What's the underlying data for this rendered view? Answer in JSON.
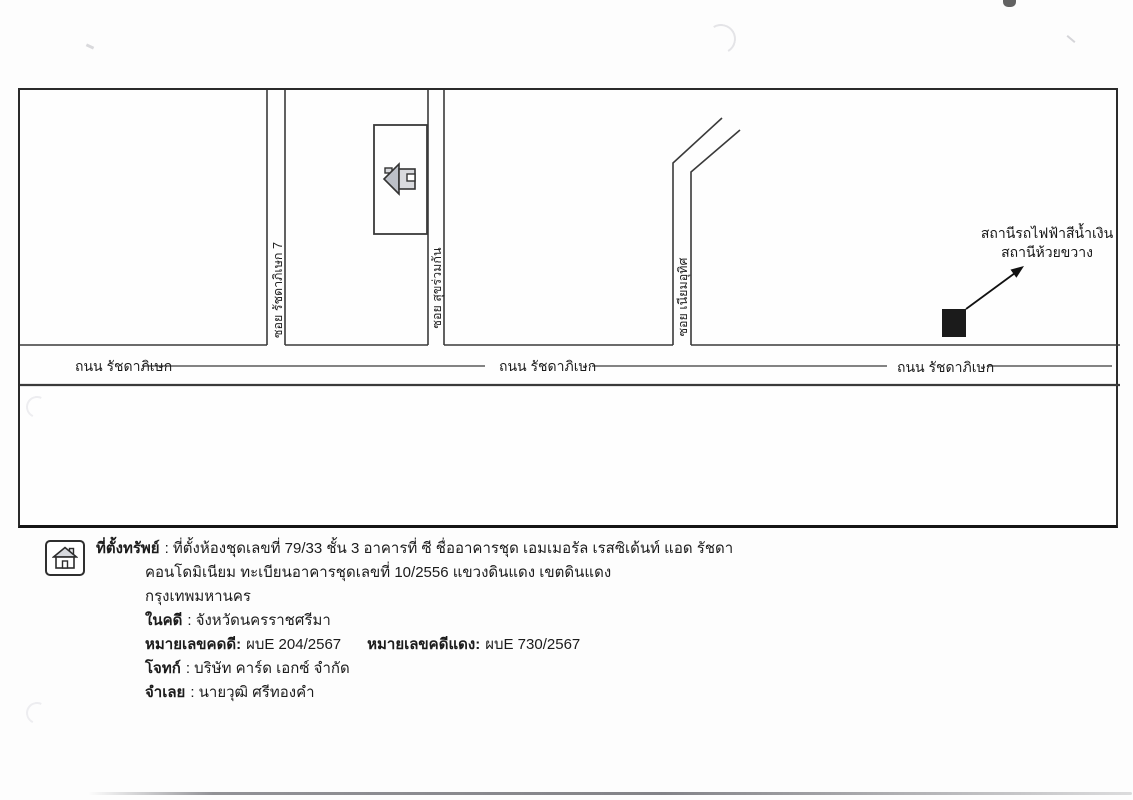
{
  "map": {
    "road_label_left": "ถนน รัชดาภิเษก",
    "road_label_center": "ถนน รัชดาภิเษก",
    "road_label_right": "ถนน รัชดาภิเษก",
    "soi_label_1": "ซอย รัชดาภิเษก 7",
    "soi_label_2": "ซอย สุขร่วมกัน",
    "soi_label_3": "ซอย เนียมอุทิศ",
    "station_note_line1": "สถานีรถไฟฟ้าสีน้ำเงิน",
    "station_note_line2": "สถานีห้วยขวาง",
    "markers": {
      "property": "house-icon",
      "station": "black-square-marker",
      "pointer": "arrow-icon"
    },
    "colors": {
      "line": "#3a3a3a",
      "station_marker_fill": "#1b1b1b",
      "house_roof": "#bcc0c8",
      "house_body": "#d9dade"
    }
  },
  "info": {
    "legend_icon": "house-icon",
    "location": {
      "label": "ที่ตั้งทรัพย์",
      "line1": ": ที่ตั้งห้องชุดเลขที่ 79/33 ชั้น 3 อาคารที่ ซี ชื่ออาคารชุด เอมเมอรัล เรสซิเด้นท์ แอด รัชดา",
      "line2": "คอนโดมิเนียม ทะเบียนอาคารชุดเลขที่ 10/2556 แขวงดินแดง เขตดินแดง",
      "line3": "กรุงเทพมหานคร"
    },
    "court_case": {
      "label": "ในคดี",
      "value": ": จังหวัดนครราชศรีมา"
    },
    "case_numbers": {
      "black_label": "หมายเลขคดดี:",
      "black_value": "ผบE 204/2567",
      "red_label": "หมายเลขคดีแดง:",
      "red_value": "ผบE 730/2567"
    },
    "plaintiff": {
      "label": "โจทก์",
      "value": ": บริษัท คาร์ด เอกซ์ จำกัด"
    },
    "defendant": {
      "label": "จำเลย",
      "value": ": นายวุฒิ ศรีทองคำ"
    }
  }
}
